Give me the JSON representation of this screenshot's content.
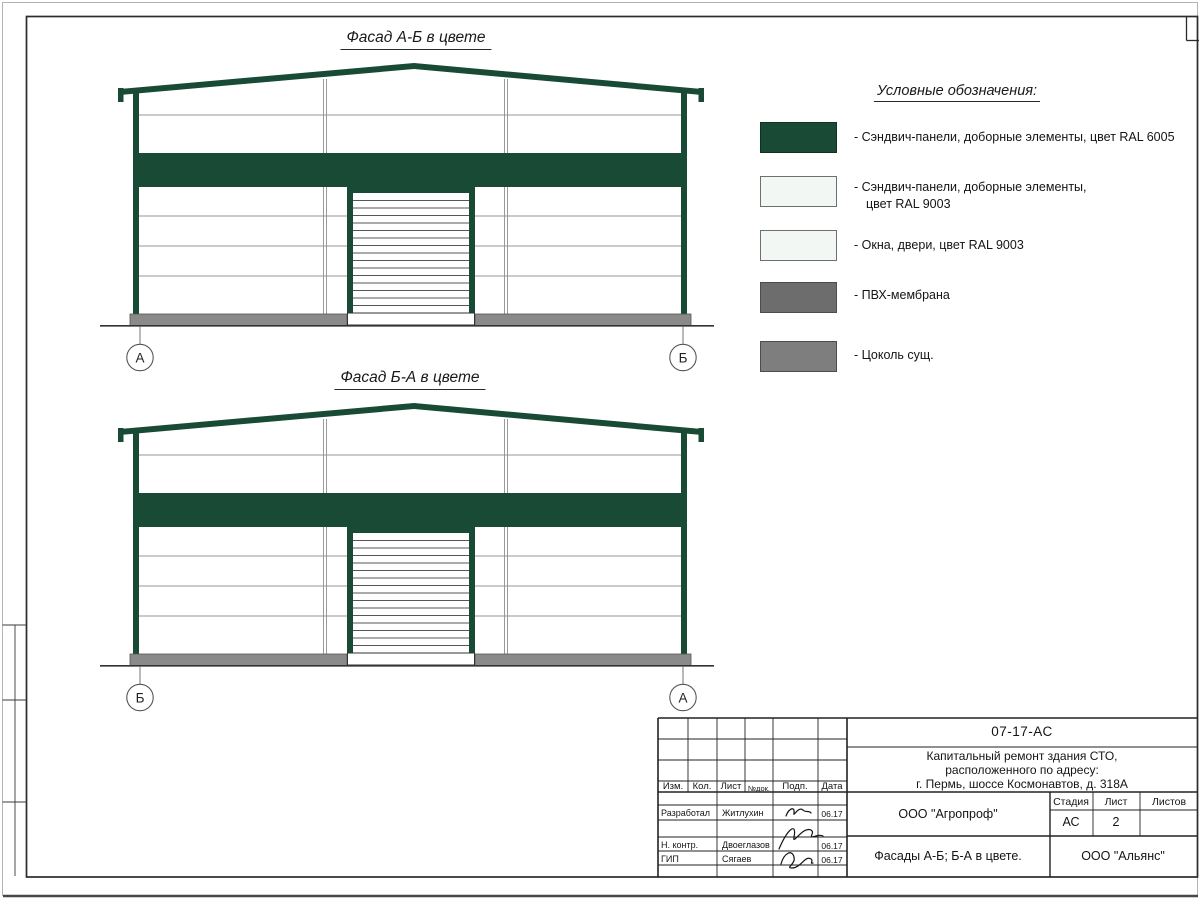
{
  "sheet": {
    "facades": [
      {
        "title": "Фасад А-Б в цвете",
        "axis_left": "А",
        "axis_right": "Б"
      },
      {
        "title": "Фасад Б-А в цвете",
        "axis_left": "Б",
        "axis_right": "А"
      }
    ],
    "legend": {
      "title": "Условные обозначения:",
      "items": [
        {
          "label": "- Сэндвич-панели, доборные элементы,  цвет RAL 6005",
          "color": "#184a35"
        },
        {
          "label": "- Сэндвич-панели, доборные элементы,",
          "label2": "цвет RAL 9003",
          "color": "#f2f7f3"
        },
        {
          "label": "- Окна, двери, цвет RAL 9003",
          "color": "#f2f7f3"
        },
        {
          "label": "- ПВХ-мембрана",
          "color": "#6d6d6d"
        },
        {
          "label": "- Цоколь сущ.",
          "color": "#7e7e7e"
        }
      ]
    },
    "title_block": {
      "doc_code": "07-17-АС",
      "project_line1": "Капитальный ремонт здания СТО,",
      "project_line2": "расположенного по адресу:",
      "project_line3": "г. Пермь, шоссе Космонавтов, д. 318А",
      "header_cols": [
        "Изм.",
        "Кол.",
        "Лист",
        "№док.",
        "Подп.",
        "Дата"
      ],
      "rows": [
        {
          "role": "Разработал",
          "name": "Житлухин",
          "date": "06.17"
        },
        {
          "role": "Н. контр.",
          "name": "Двоеглазов",
          "date": "06.17"
        },
        {
          "role": "ГИП",
          "name": "Сягаев",
          "date": "06.17"
        }
      ],
      "org": "ООО \"Агропроф\"",
      "stage_label": "Стадия",
      "sheet_label": "Лист",
      "sheets_label": "Листов",
      "stage_value": "АС",
      "sheet_value": "2",
      "drawing_title": "Фасады А-Б; Б-А в цвете.",
      "contractor": "ООО \"Альянс\""
    },
    "drawing_colors": {
      "ral6005_green": "#184a35",
      "plinth_gray": "#8a8a8a",
      "wall_white": "#ffffff"
    }
  }
}
